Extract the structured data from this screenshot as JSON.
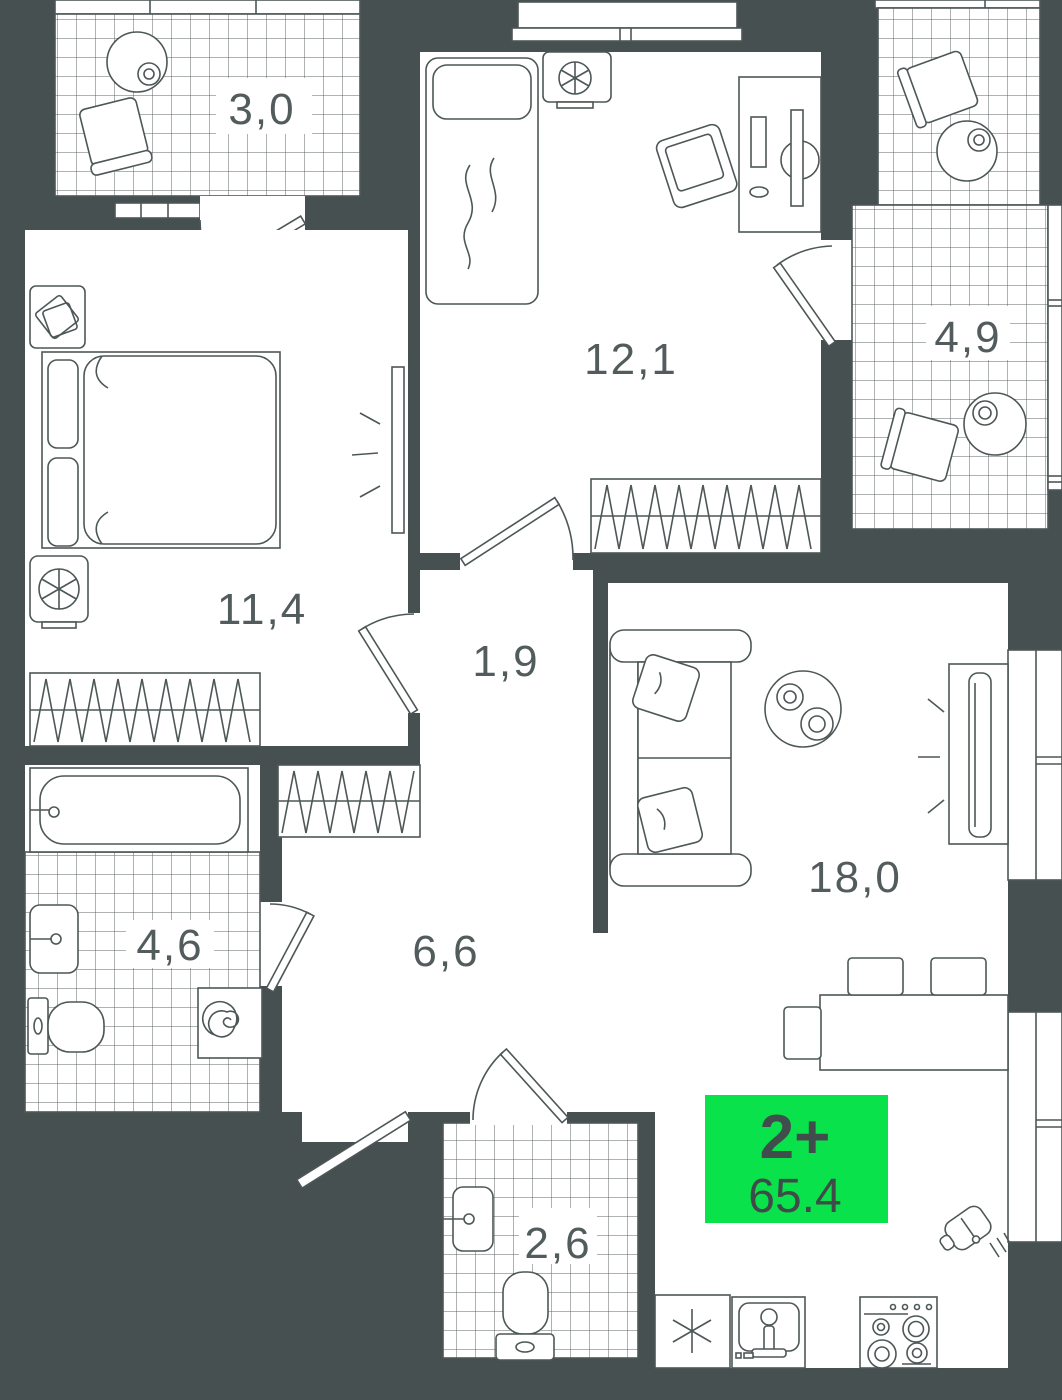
{
  "plan": {
    "badge": {
      "rooms_label": "2+",
      "area_value": "65.4",
      "bg": "#0ae24c",
      "text_color": "#414c4c"
    },
    "colors": {
      "wall": "#475050",
      "floor": "#ffffff",
      "line": "#4d5757",
      "label": "#525c5c",
      "tile_line": "#5d6666",
      "accent_green": "#0ae24c"
    },
    "rooms": [
      {
        "id": "balcony-top-left",
        "type": "balcony",
        "area_label": "3,0"
      },
      {
        "id": "bedroom-top",
        "type": "bedroom",
        "area_label": "12,1"
      },
      {
        "id": "loggia-right",
        "type": "balcony",
        "area_label": "4,9"
      },
      {
        "id": "bedroom-left",
        "type": "bedroom",
        "area_label": "11,4"
      },
      {
        "id": "hall-inner",
        "type": "hallway",
        "area_label": "1,9"
      },
      {
        "id": "bathroom-left",
        "type": "bathroom",
        "area_label": "4,6"
      },
      {
        "id": "hallway-main",
        "type": "hallway",
        "area_label": "6,6"
      },
      {
        "id": "living-kitchen",
        "type": "living-room-kitchen",
        "area_label": "18,0"
      },
      {
        "id": "wc-bottom",
        "type": "bathroom",
        "area_label": "2,6"
      }
    ],
    "icons": [
      "round-table",
      "chair",
      "single-bed",
      "double-bed",
      "nightstand",
      "ac-fan-unit",
      "wardrobe",
      "mirror",
      "desk",
      "desk-chair",
      "bathtub",
      "sink",
      "toilet",
      "washing-machine",
      "sofa",
      "coffee-table",
      "tv",
      "bar-counter",
      "bar-stool",
      "fridge-snowflake",
      "kitchen-sink",
      "stove",
      "cutting-board",
      "door-leaf",
      "window"
    ]
  }
}
